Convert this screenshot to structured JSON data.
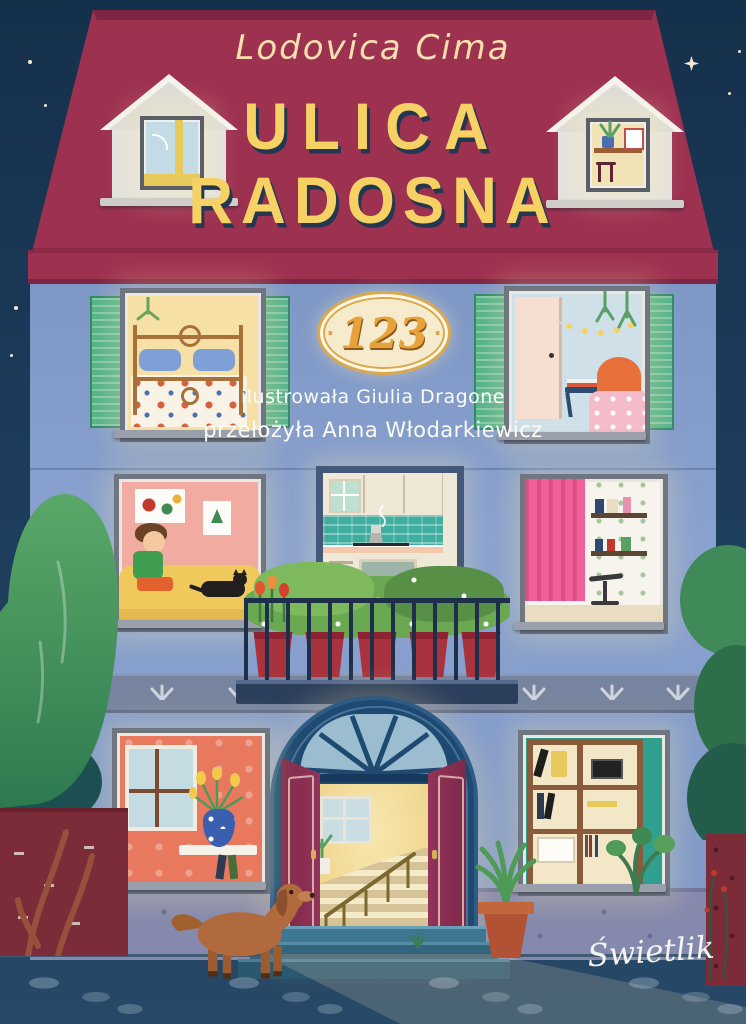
{
  "cover": {
    "author": "Lodovica Cima",
    "title_line1": "ULICA",
    "title_line2": "RADOSNA",
    "badge": {
      "number": "123",
      "dot": "·"
    },
    "credits": {
      "illustrator": "ilustrowała Giulia Dragone",
      "translator": "przełożyła Anna Włodarkiewicz"
    },
    "publisher": "Świetlik",
    "colors": {
      "sky": "#1d3c5c",
      "roof": "#9d3150",
      "facade": "#7f99c7",
      "shutter_green": "#56b28b",
      "title_yellow": "#f6d265",
      "title_shadow": "#233752",
      "author_cream": "#f7dfae",
      "credits_white": "#fcfcf8",
      "badge_background": "#f6eccd",
      "badge_gold": "#e8a23c",
      "door_maroon": "#8c2f52",
      "portal_navy": "#1e4a72",
      "hall_yellow": "#f3da8e",
      "balcony_pot_red": "#a8323e",
      "steps_teal": "#2f637e",
      "pavement": "#5d7a93",
      "tree_green": "#3f8a58"
    }
  }
}
